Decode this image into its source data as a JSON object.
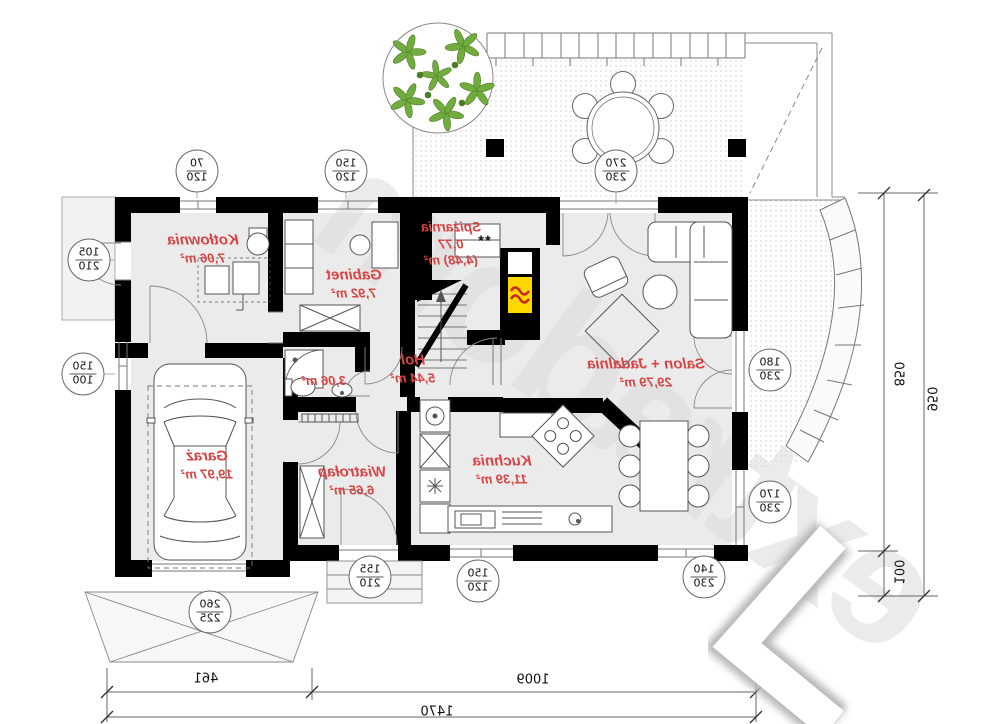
{
  "plan": {
    "rooms": [
      {
        "name": "Kotłownia",
        "area": "7,06 m²"
      },
      {
        "name": "Gabinet",
        "area": "7,92 m²"
      },
      {
        "name": "Spiżarnia",
        "area": "0,77",
        "area_alt": "(4,48) m²"
      },
      {
        "name": "",
        "area": "3,06 m²"
      },
      {
        "name": "Hol",
        "area": "5,44 m²"
      },
      {
        "name": "Salon + Jadalnia",
        "area": "29,79 m²"
      },
      {
        "name": "Kuchnia",
        "area": "11,39 m²"
      },
      {
        "name": "Wiatrołap",
        "area": "6,65 m²"
      },
      {
        "name": "Garaż",
        "area": "19,97 m²"
      }
    ],
    "pantry_marker": "**",
    "dim_tags": [
      {
        "w": "70",
        "h": "120"
      },
      {
        "w": "150",
        "h": "120"
      },
      {
        "w": "270",
        "h": "230"
      },
      {
        "w": "105",
        "h": "210"
      },
      {
        "w": "150",
        "h": "100"
      },
      {
        "w": "180",
        "h": "230"
      },
      {
        "w": "170",
        "h": "230"
      },
      {
        "w": "155",
        "h": "210"
      },
      {
        "w": "150",
        "h": "120"
      },
      {
        "w": "140",
        "h": "230"
      },
      {
        "w": "260",
        "h": "225"
      }
    ],
    "linear_dims": {
      "depth": "850",
      "depth_total": "950",
      "terrace_step": "100",
      "front_garage": "461",
      "front_main": "1009",
      "front_total": "1470"
    },
    "watermark": "extradom",
    "colors": {
      "wall": "#000000",
      "label_red": "#d94444",
      "fireplace_yellow": "#ffd800",
      "flame_red": "#cc2222",
      "tree_green": "#72ac3e"
    }
  }
}
